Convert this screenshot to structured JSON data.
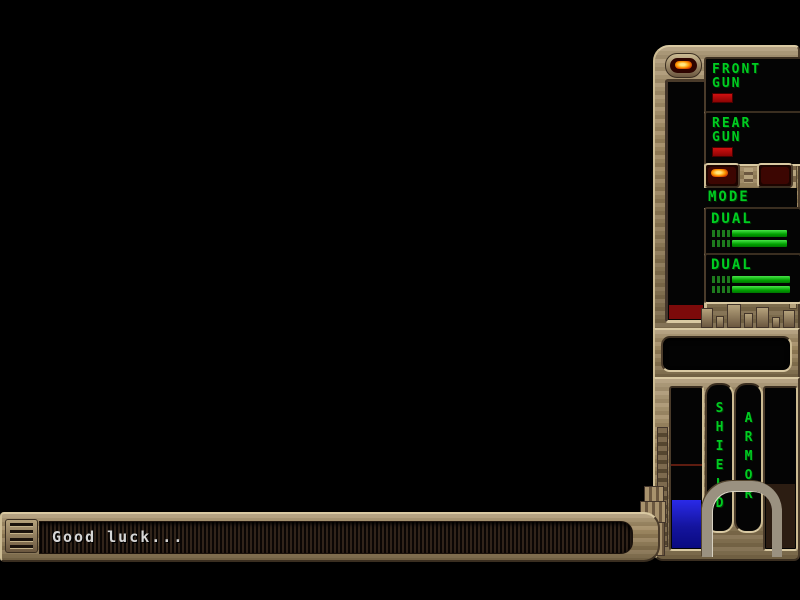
{
  "screen": {
    "background": "#000000"
  },
  "weapon_panel": {
    "front_gun": {
      "line1": "FRONT",
      "line2": "GUN"
    },
    "rear_gun": {
      "line1": "REAR",
      "line2": "GUN"
    },
    "mode_label": "MODE",
    "dual_primary": {
      "label": "DUAL",
      "bar_pct": 62
    },
    "dual_secondary": {
      "label": "DUAL",
      "bar_pct": 66
    },
    "energy_fill_pct": 6
  },
  "status_panel": {
    "shield_label": "SHIELD",
    "armor_label": "ARMOR",
    "shield_fill_pct": 30,
    "armor_fill_pct": 40
  },
  "message_bar": {
    "text": "Good luck..."
  },
  "colors": {
    "lcd_green": "#00cc22",
    "indicator_red": "#b40000",
    "led_lit_orange": "#ff9a00",
    "shield_blue": "#1a1ad0",
    "armor_brown": "#2c1d12",
    "panel_tan": "#9c865f"
  },
  "icons": {
    "power_led": "power-led-icon",
    "mode_led_active": "mode-led-active-icon",
    "mode_led_inactive": "mode-led-inactive-icon",
    "speaker_grille": "speaker-grille-icon"
  }
}
